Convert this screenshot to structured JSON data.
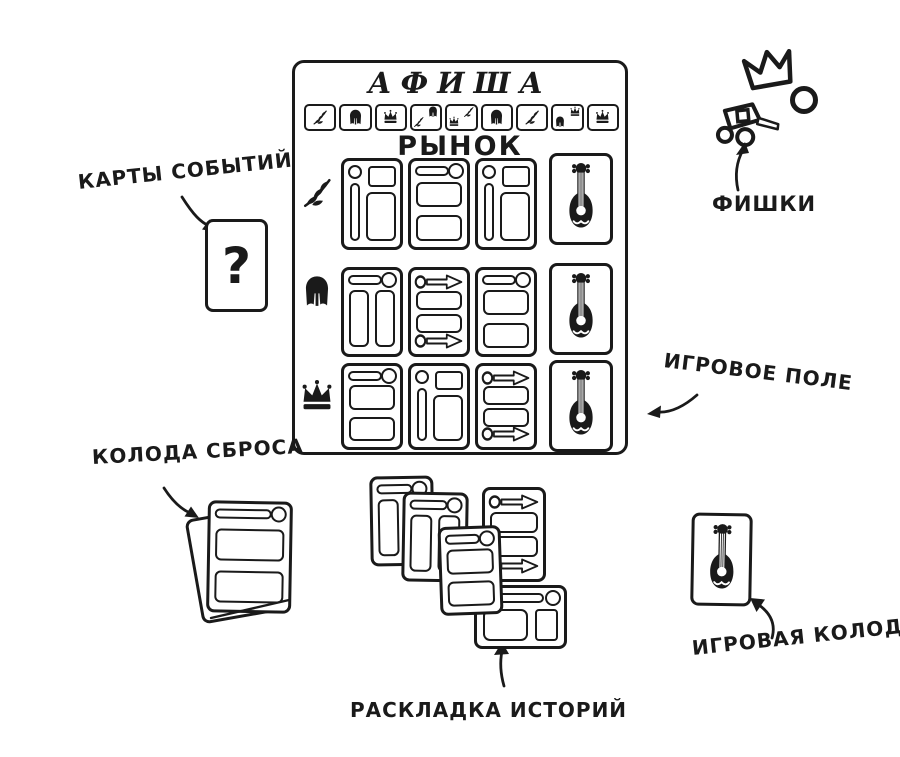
{
  "page": {
    "paper_color": "#ffffff",
    "ink_color": "#1a1a1a"
  },
  "board": {
    "title": "АФИША",
    "market_title": "РЫНОК",
    "strip_icons": [
      "branch",
      "helmet",
      "crown",
      "branch-helmet",
      "crown-branch",
      "helmet",
      "branch",
      "helmet-crown",
      "crown"
    ],
    "market_rows": [
      {
        "icon": "branch",
        "cards": [
          "portrait",
          "title-stack",
          "portrait"
        ]
      },
      {
        "icon": "helmet",
        "cards": [
          "title-cols",
          "arrows",
          "title-stack"
        ]
      },
      {
        "icon": "crown",
        "cards": [
          "title-stack",
          "portrait",
          "arrows"
        ]
      }
    ],
    "deck_column_cards": [
      "lute",
      "lute",
      "lute"
    ]
  },
  "event_card": {
    "glyph": "?"
  },
  "annotations": {
    "event_cards": {
      "label": "КАРТЫ СОБЫТИЙ"
    },
    "tokens": {
      "label": "ФИШКИ",
      "items": [
        "crown-token",
        "ring-token",
        "cart-token"
      ]
    },
    "game_board": {
      "label": "ИГРОВОЕ ПОЛЕ"
    },
    "discard_pile": {
      "label": "КОЛОДА СБРОСА"
    },
    "story_layout": {
      "label": "РАСКЛАДКА ИСТОРИЙ",
      "cards": [
        "title-cols",
        "title-cols",
        "arrows",
        "landscape",
        "title-stack"
      ]
    },
    "game_deck": {
      "label": "ИГРОВАЯ КОЛОДА",
      "card": "lute"
    }
  }
}
